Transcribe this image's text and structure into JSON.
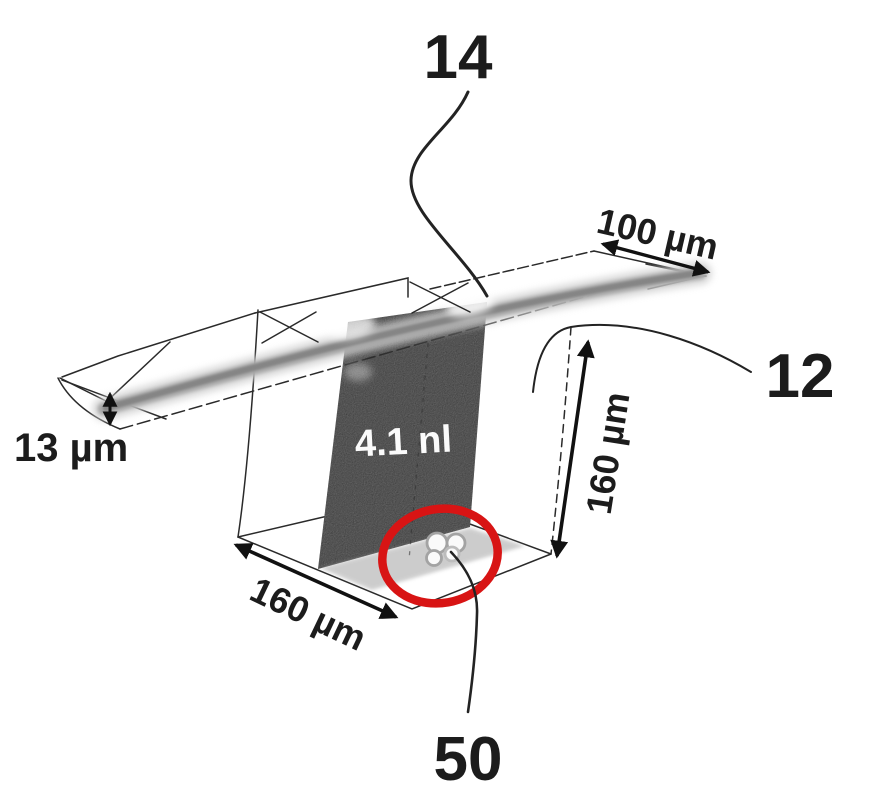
{
  "figure": {
    "labels": {
      "ref_channel": "14",
      "ref_chamber": "12",
      "ref_cells": "50",
      "volume": "4.1 nl"
    },
    "dimensions": {
      "channel_width": "100 µm",
      "channel_height": "13 µm",
      "chamber_height": "160 µm",
      "chamber_width": "160 µm"
    },
    "colors": {
      "highlight_ring": "#d81414",
      "liquid_fill": "#7e7e7e",
      "line_ink": "#2a2a2a"
    }
  }
}
